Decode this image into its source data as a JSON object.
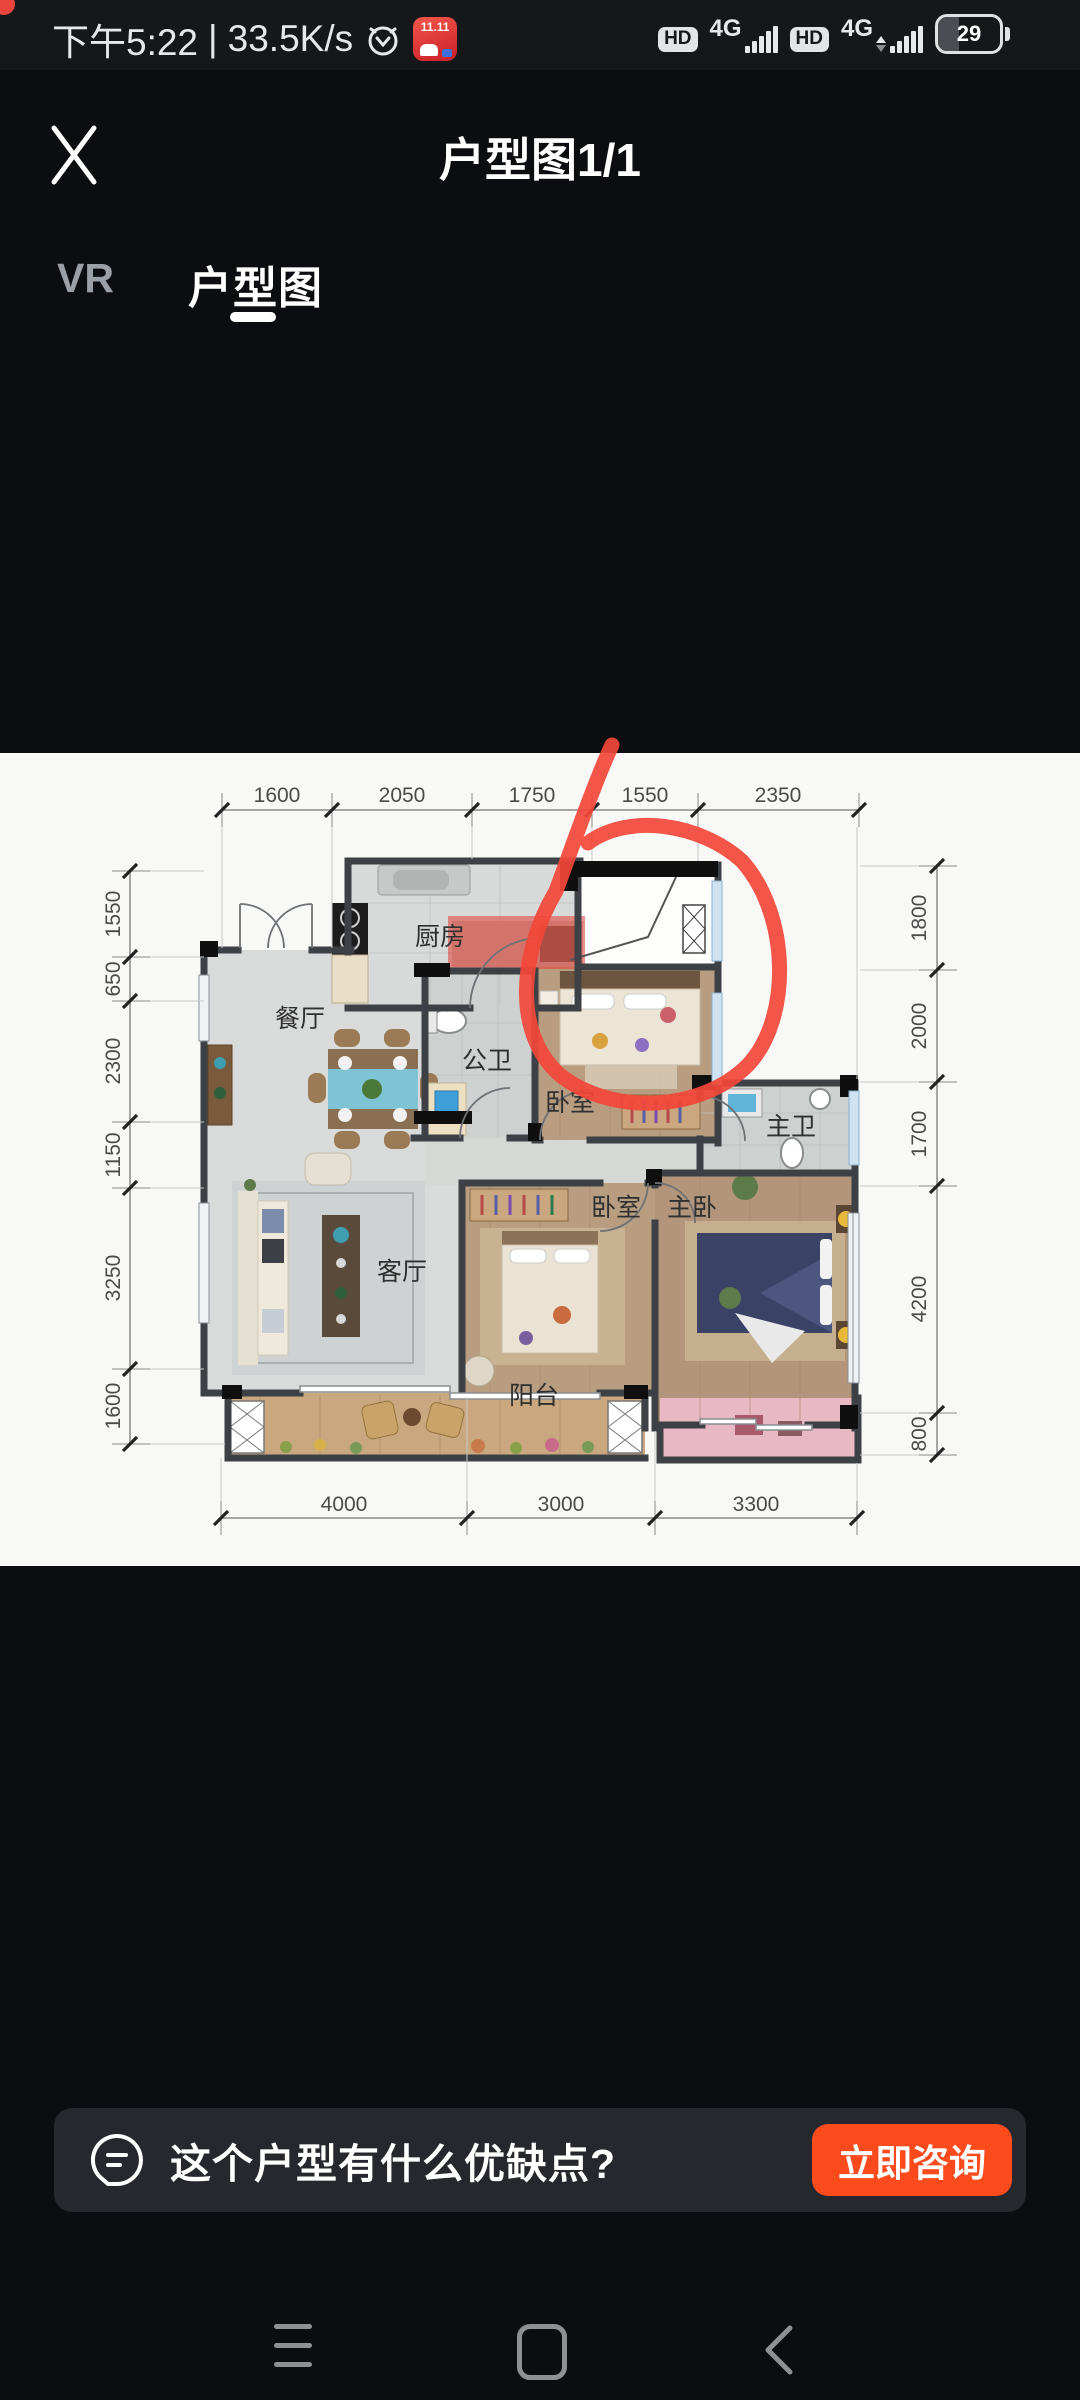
{
  "colors": {
    "accent_orange": "#fb4b1c",
    "annotation_red": "#f2473a",
    "background": "#15171a"
  },
  "status_bar": {
    "time": "下午5:22",
    "divider": "|",
    "speed": "33.5K/s",
    "app_badge": "11.11",
    "hd": "HD",
    "net_type": "4G",
    "battery_percent": "29"
  },
  "header": {
    "title": "户型图1/1"
  },
  "tabs": {
    "vr": "VR",
    "floorplan": "户型图"
  },
  "floorplan": {
    "rooms": {
      "kitchen": "厨房",
      "dining": "餐厅",
      "public_bath": "公卫",
      "bedroom_top": "卧室",
      "master_bath": "主卫",
      "bedroom_mid": "卧室",
      "master_bedroom": "主卧",
      "living": "客厅",
      "balcony": "阳台"
    },
    "dims": {
      "top": [
        "1600",
        "2050",
        "1750",
        "1550",
        "2350"
      ],
      "bottom": [
        "4000",
        "3000",
        "3300"
      ],
      "left": [
        "1550",
        "650",
        "2300",
        "1150",
        "3250",
        "1600"
      ],
      "right": [
        "1800",
        "2000",
        "1700",
        "4200",
        "800"
      ]
    }
  },
  "consult_bar": {
    "question": "这个户型有什么优缺点?",
    "cta": "立即咨询"
  }
}
